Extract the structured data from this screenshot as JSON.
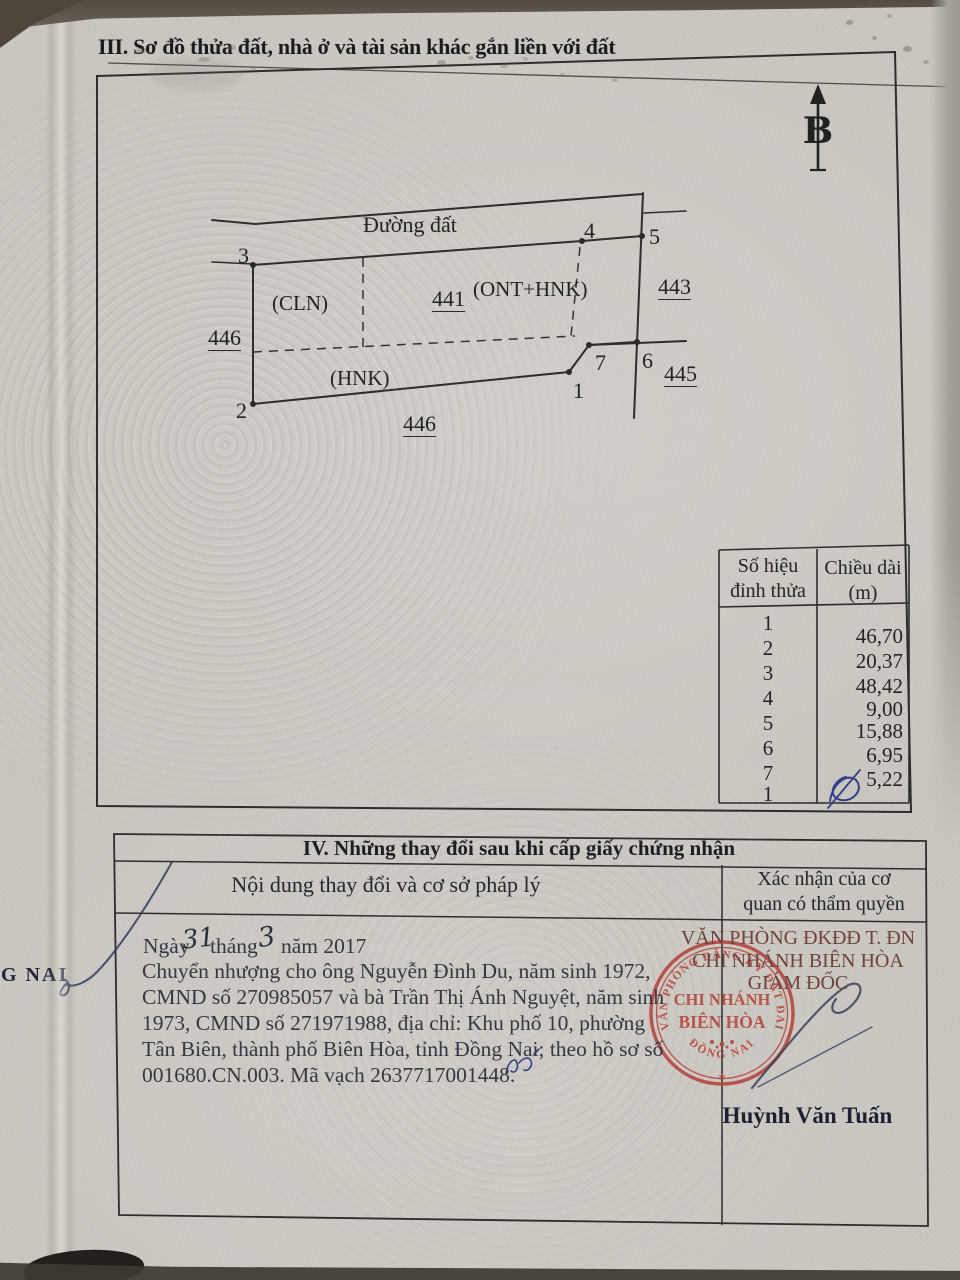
{
  "document": {
    "section3": {
      "title": "III. Sơ đồ thửa đất, nhà ở và tài sản khác gắn liền với đất"
    },
    "diagram": {
      "north_symbol": "B",
      "road_label": "Đường đất",
      "parcel_number": "441",
      "zone_labels": {
        "cln": "(CLN)",
        "ont_hnk": "(ONT+HNK)",
        "hnk": "(HNK)"
      },
      "neighbor_parcels": {
        "west": "446",
        "east": "443",
        "southeast": "445",
        "south": "446"
      },
      "vertices": {
        "v1": "1",
        "v2": "2",
        "v3": "3",
        "v4": "4",
        "v5": "5",
        "v6": "6",
        "v7": "7"
      }
    },
    "vertex_table": {
      "header": {
        "col1_line1": "Số hiệu",
        "col1_line2": "đỉnh thửa",
        "col2_line1": "Chiều dài",
        "col2_line2": "(m)"
      },
      "vertex_ids": [
        "1",
        "2",
        "3",
        "4",
        "5",
        "6",
        "7",
        "1"
      ],
      "lengths_m": [
        "46,70",
        "20,37",
        "48,42",
        "9,00",
        "15,88",
        "6,95",
        "5,22"
      ]
    },
    "section4": {
      "title": "IV. Những thay đổi sau khi cấp giấy chứng nhận",
      "col1_header": "Nội dung thay đổi và cơ sở pháp lý",
      "col2_header_line1": "Xác nhận của cơ",
      "col2_header_line2": "quan có thẩm quyền",
      "entry": {
        "date_prefix": "Ngày",
        "date_day": "31",
        "date_middle": "tháng",
        "date_month": "3",
        "date_suffix": "năm 2017",
        "lines": [
          "Chuyển nhượng cho ông Nguyễn Đình Du, năm sinh 1972,",
          "CMND số 270985057 và bà Trần Thị Ánh Nguyệt, năm sinh",
          "1973, CMND số 271971988, địa chỉ: Khu phố 10, phường",
          "Tân Biên, thành phố Biên Hòa, tỉnh Đồng Nai; theo hồ sơ số",
          "001680.CN.003. Mã vạch 2637717001448."
        ]
      },
      "authority": {
        "office_line1": "VĂN PHÒNG ĐKĐĐ T. ĐN",
        "office_line2": "CHI NHÁNH BIÊN HÒA",
        "office_line3": "GIÁM ĐỐC",
        "signer": "Huỳnh Văn Tuấn",
        "stamp": {
          "ring_top": "VĂN PHÒNG ĐĂNG KÝ ĐẤT ĐAI",
          "ring_bottom": "ĐỒNG NAI",
          "center_line1": "CHI NHÁNH",
          "center_line2": "BIÊN HÒA",
          "star": "★"
        }
      }
    },
    "margin_text": "G NAI"
  },
  "colors": {
    "stamp_red": "#b5443c",
    "authority_red": "#6e433c",
    "pen_blue": "#33408a",
    "ink_dark": "#2e2d2b"
  }
}
